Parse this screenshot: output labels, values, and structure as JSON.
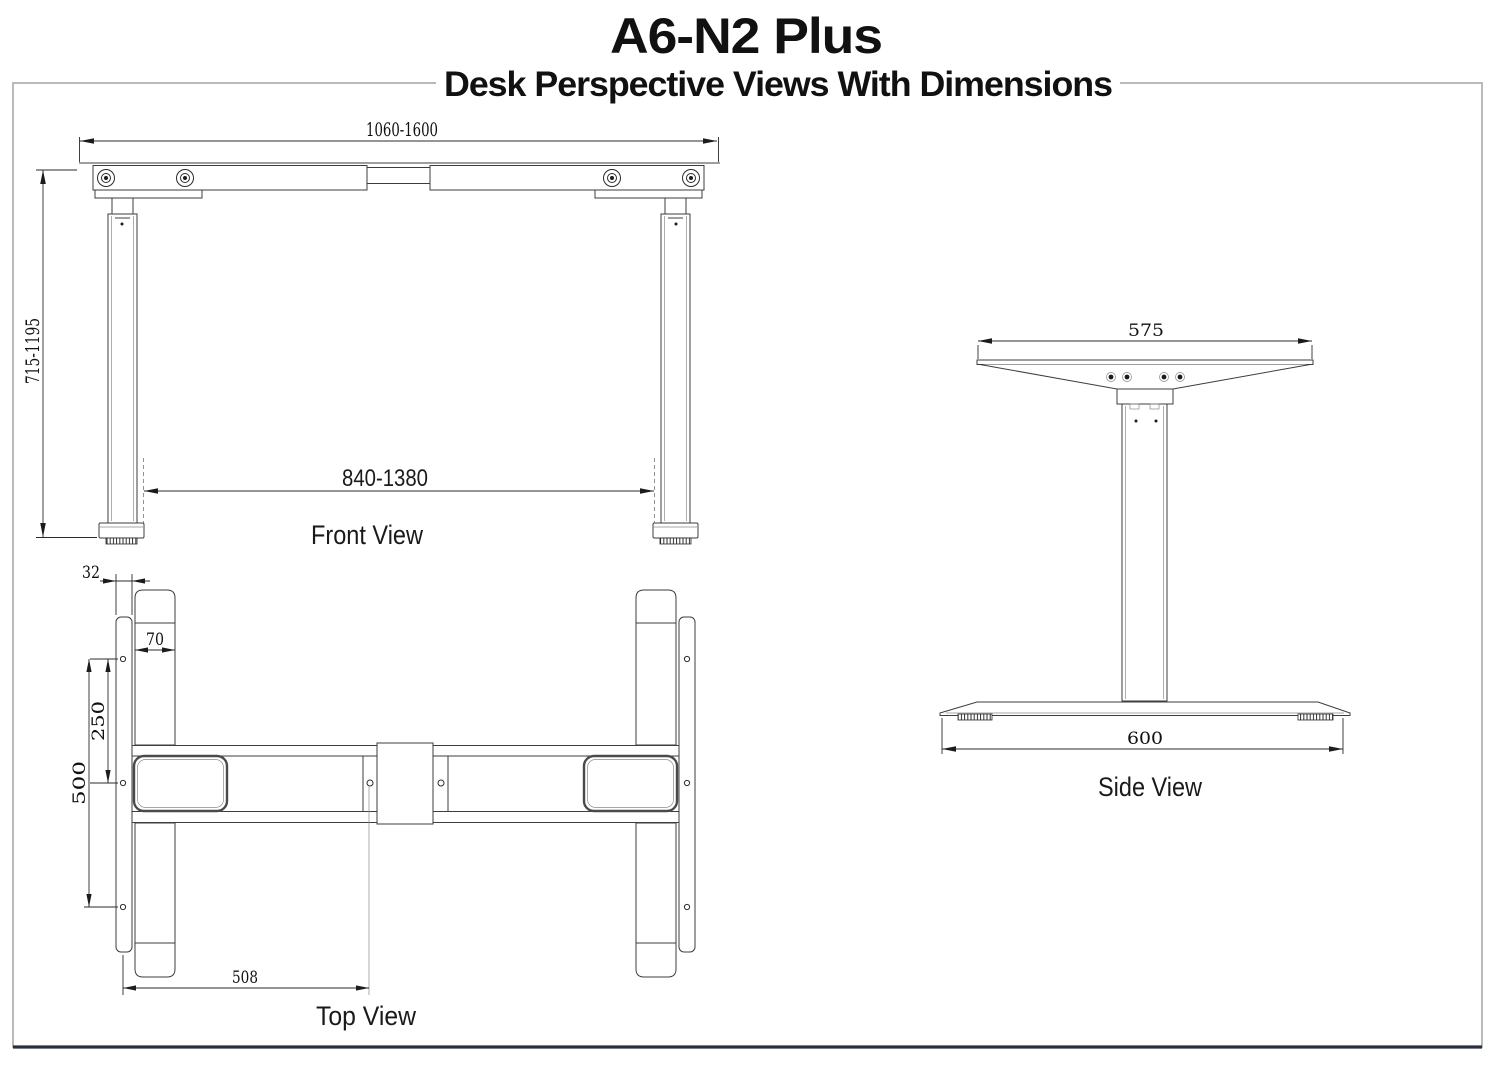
{
  "title": "A6-N2 Plus",
  "subtitle": "Desk Perspective Views With Dimensions",
  "front_view": {
    "label": "Front View",
    "width_range": "1060-1600",
    "height_range": "715-1195",
    "leg_span_range": "840-1380"
  },
  "side_view": {
    "label": "Side View",
    "top_width": "575",
    "base_depth": "600"
  },
  "top_view": {
    "label": "Top View",
    "bracket_thickness": "32",
    "foot_width": "70",
    "hole_spacing_small": "250",
    "hole_spacing_large": "500",
    "beam_offset": "508"
  },
  "colors": {
    "line": "#3d3d3d",
    "bold_line": "#4a4a4a",
    "border": "#a8a8a8",
    "border_bottom": "#2a3040"
  }
}
